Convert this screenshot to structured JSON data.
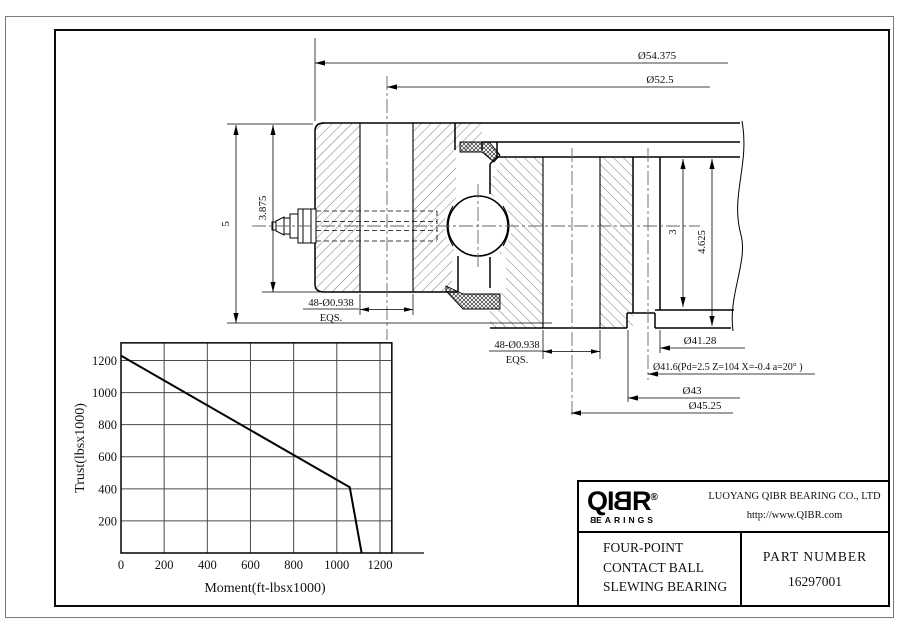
{
  "drawing": {
    "dim_od": "Ø54.375",
    "dim_bolt_circle_left": "Ø52.5",
    "dim_height_total": "5",
    "dim_height_left": "3.875",
    "holes_left_line1": "48-Ø0.938",
    "holes_left_line2": "EQS.",
    "holes_right_line1": "48-Ø0.938",
    "holes_right_line2": "EQS.",
    "dim_d_41_28": "Ø41.28",
    "dim_gear": "Ø41.6(Pd=2.5 Z=104 X=-0.4 a=20° )",
    "dim_d_43": "Ø43",
    "dim_d_45_25": "Ø45.25",
    "dim_gear_face": "3",
    "dim_height_right": "4.625"
  },
  "chart_data": {
    "type": "line",
    "title": "",
    "xlabel": "Moment(ft-lbsx1000)",
    "ylabel": "Trust(lbsx1000)",
    "xticks": [
      0,
      200,
      400,
      600,
      800,
      1000,
      1200
    ],
    "yticks": [
      200,
      400,
      600,
      800,
      1000,
      1200
    ],
    "xlim": [
      0,
      1255
    ],
    "ylim": [
      0,
      1310
    ],
    "grid": true,
    "legend": false,
    "series": [
      {
        "name": "load-capacity-curve",
        "points": [
          [
            0,
            1230
          ],
          [
            1060,
            410
          ],
          [
            1115,
            0
          ]
        ]
      }
    ]
  },
  "title_block": {
    "logo": {
      "l1": "Q",
      "l2": "I",
      "l3": "B",
      "l4": "R",
      "registered": "®",
      "sub_first": "B",
      "sub_rest": "EARINGS"
    },
    "company_line1": "LUOYANG QIBR BEARING CO., LTD",
    "company_line2": "http://www.QIBR.com",
    "product_line1": "FOUR-POINT",
    "product_line2": "CONTACT BALL",
    "product_line3": "SLEWING BEARING",
    "part_label": "PART NUMBER",
    "part_number": "16297001"
  }
}
